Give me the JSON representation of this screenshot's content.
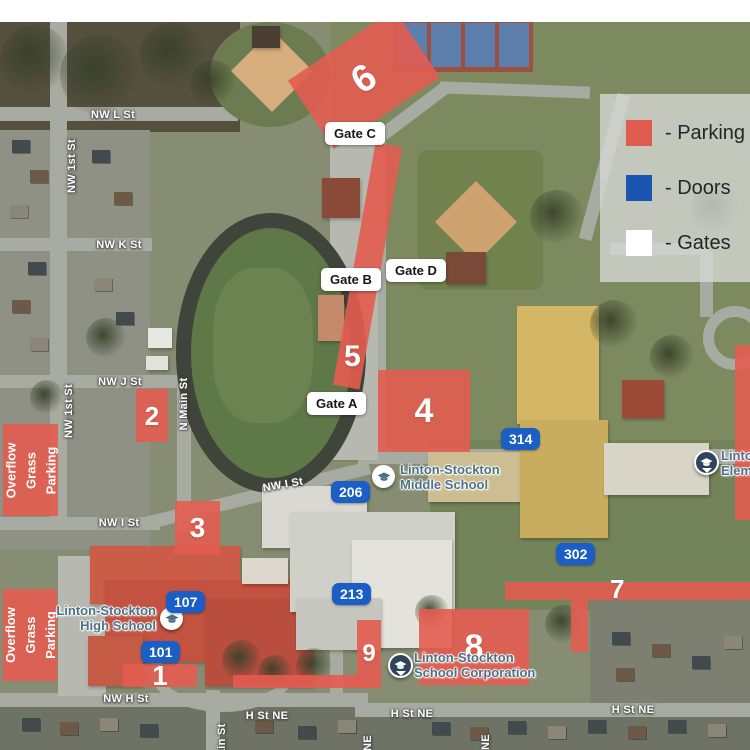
{
  "legend": {
    "items": [
      {
        "label": "- Parking",
        "swatch_color": "#e05c50"
      },
      {
        "label": "- Doors",
        "swatch_color": "#1a55b2"
      },
      {
        "label": "- Gates",
        "swatch_color": "#ffffff"
      }
    ]
  },
  "parking_areas": [
    {
      "id": "lot-6",
      "label": "6"
    },
    {
      "id": "lot-5",
      "label": "5"
    },
    {
      "id": "lot-4",
      "label": "4"
    },
    {
      "id": "lot-2",
      "label": "2"
    },
    {
      "id": "lot-3",
      "label": "3"
    },
    {
      "id": "lot-1",
      "label": "1"
    },
    {
      "id": "lot-9",
      "label": "9"
    },
    {
      "id": "lot-8",
      "label": "8"
    },
    {
      "id": "lot-7",
      "label": "7"
    },
    {
      "id": "overflow-north",
      "lines": [
        "Overflow",
        "Grass",
        "Parking"
      ]
    },
    {
      "id": "overflow-south",
      "lines": [
        "Overflow",
        "Grass",
        "Parking"
      ]
    }
  ],
  "gates": [
    {
      "label": "Gate C"
    },
    {
      "label": "Gate B"
    },
    {
      "label": "Gate D"
    },
    {
      "label": "Gate A"
    }
  ],
  "doors": [
    {
      "label": "314"
    },
    {
      "label": "206"
    },
    {
      "label": "302"
    },
    {
      "label": "213"
    },
    {
      "label": "107"
    },
    {
      "label": "101"
    }
  ],
  "schools": [
    {
      "line1": "Linton-Stockton",
      "line2": "Middle School"
    },
    {
      "line1": "Linton-Stockton",
      "line2": "High School"
    },
    {
      "line1": "Linton-Stockton",
      "line2": "School Corporation"
    },
    {
      "line1": "Linton-Stockton",
      "line2": "Elementary"
    }
  ],
  "streets": [
    {
      "name": "NW L St"
    },
    {
      "name": "NW 1st St"
    },
    {
      "name": "NW K St"
    },
    {
      "name": "NW J St"
    },
    {
      "name": "NW 1st St"
    },
    {
      "name": "N Main St"
    },
    {
      "name": "NW I St"
    },
    {
      "name": "NW I St"
    },
    {
      "name": "NW H St"
    },
    {
      "name": "H St NE"
    },
    {
      "name": "H St NE"
    },
    {
      "name": "H St NE"
    },
    {
      "name": "Main St"
    },
    {
      "name": "NE"
    },
    {
      "name": "NE"
    }
  ],
  "colors": {
    "parking_overlay": "#e35c50",
    "door_badge": "#1a5ec6",
    "gate_pill": "#ffffff",
    "poi_label": "#4d7185"
  }
}
